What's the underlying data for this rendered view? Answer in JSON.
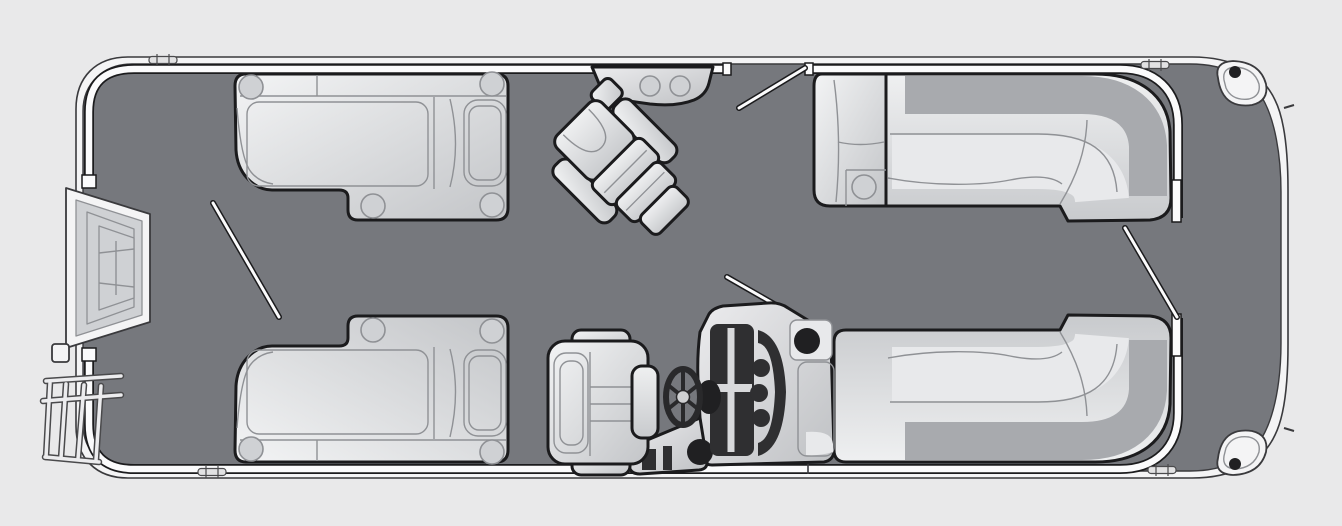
{
  "meta": {
    "title": "Pontoon boat floor plan",
    "view": "top-down deck layout illustration",
    "visible_text": "none"
  },
  "canvas": {
    "width": 1342,
    "height": 526,
    "viewBox": "0 0 1342 526"
  },
  "colors": {
    "background": "#e9e9ea",
    "deck": "#76787d",
    "hull_rim": "#f4f4f5",
    "fence_white": "#fbfbfc",
    "line_dark": "#3a3a3d",
    "outline_dark": "#1b1b1d",
    "seat_hi": "#f1f2f3",
    "seat_lo": "#c7c9cc",
    "seat_light": "#e8e9eb",
    "seat_mid": "#cfd1d4",
    "seat_band": "#a8aaae",
    "seam": "#8f9195",
    "panel_dark": "#2f2f31",
    "darkest": "#202022"
  },
  "boat": {
    "orientation": "bow at right, stern at left",
    "components": [
      {
        "name": "hull",
        "desc": "rounded pontoon deck with white rub-rail band and inner perimeter fence"
      },
      {
        "name": "stern-entry-steps",
        "desc": "fold-out boarding steps at left (stern) gate"
      },
      {
        "name": "stern-boarding-ladder",
        "desc": "ladder stowed off the lower-left hull"
      },
      {
        "name": "port-aft-bench",
        "desc": "straight lounge bench, upper left, 4 cup holders"
      },
      {
        "name": "starboard-aft-bench",
        "desc": "mirrored lounge bench, lower left, 4 cup holders"
      },
      {
        "name": "swivel-recliner-chair",
        "desc": "freestanding recliner rotated toward bow-port, center deck"
      },
      {
        "name": "port-rail-console",
        "desc": "small rail-mounted console with 2 cup holders, top center"
      },
      {
        "name": "port-bow-l-lounge",
        "desc": "wraparound L-lounge with chaise end and 1 cup holder, upper right"
      },
      {
        "name": "starboard-bow-l-lounge",
        "desc": "mirrored wraparound L-lounge, lower right"
      },
      {
        "name": "helm-console",
        "desc": "dashboard with instrument panel, 3 knobs, cup holder, windscreen"
      },
      {
        "name": "steering-wheel",
        "desc": "four-spoke wheel left of helm console"
      },
      {
        "name": "helm-chair",
        "desc": "captain's chair facing the bow"
      },
      {
        "name": "gate-port",
        "desc": "open gate in top rail"
      },
      {
        "name": "gate-bow",
        "desc": "open gate between bow lounges"
      },
      {
        "name": "gate-stern",
        "desc": "open gate line near stern benches"
      },
      {
        "name": "cleats",
        "count": 4
      },
      {
        "name": "bow-corner-lights",
        "count": 2
      },
      {
        "name": "cup-holders-total",
        "count": 12
      }
    ]
  }
}
